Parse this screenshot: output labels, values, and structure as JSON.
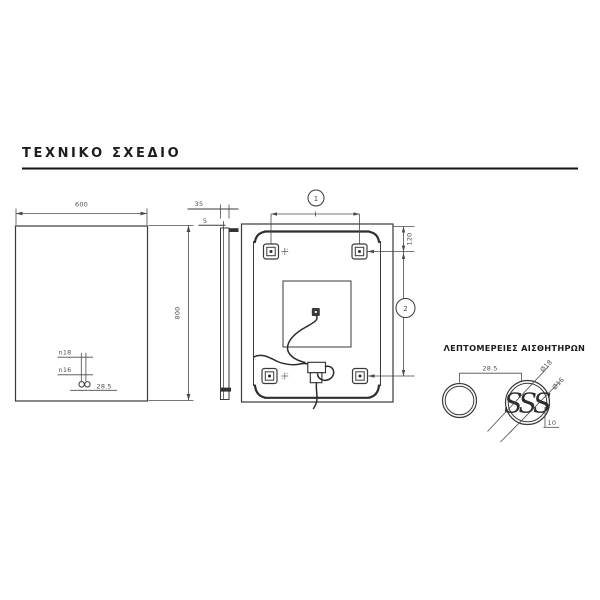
{
  "page": {
    "title": "ΤΕΧΝΙΚΟ ΣΧΕΔΙΟ"
  },
  "front_view": {
    "width": "600",
    "height": "800",
    "sensor_hole_1": "n18",
    "sensor_hole_2": "n16",
    "sensor_spacing": "28.5"
  },
  "side_view": {
    "depth": "35",
    "glass_thickness": "5"
  },
  "back_view": {
    "callout_top": "1",
    "callout_side": "2",
    "bracket_offset": "120"
  },
  "sensor_details": {
    "heading": "ΛΕΠΤΟΜΕΡΕΙΕΣ ΑΙΣΘΗΤΗΡΩΝ",
    "spacing": "28.5",
    "outer_diameter": "Ø18",
    "inner_diameter": "Ø16",
    "edge_offset": "10",
    "sensor_symbol": "SSS"
  },
  "colors": {
    "line": "#3a3a3a",
    "dimension_text": "#4f4f4f",
    "title": "#1d1d1d",
    "background": "#ffffff"
  }
}
